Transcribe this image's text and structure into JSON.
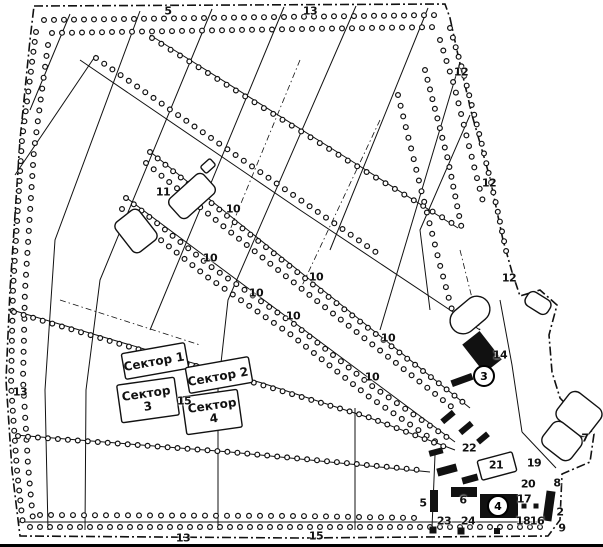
{
  "figure": {
    "type": "scanned-map-plan",
    "language": "Russian",
    "background": "#ffffff",
    "ink_color": "#111111",
    "description": "Hand-drawn scanned plan of a tree-lined territory (fan-shaped street grid converging to an entrance at lower right) divided into numbered sectors with numbered objects"
  },
  "sectors": [
    {
      "lines": [
        "Сектор 1"
      ],
      "x": 154,
      "y": 362,
      "rot": -10
    },
    {
      "lines": [
        "Сектор 2"
      ],
      "x": 218,
      "y": 377,
      "rot": -10
    },
    {
      "lines": [
        "Сектор",
        "3"
      ],
      "x": 147,
      "y": 400,
      "rot": -8
    },
    {
      "lines": [
        "Сектор",
        "4"
      ],
      "x": 213,
      "y": 412,
      "rot": -8
    }
  ],
  "labels": [
    {
      "text": "5",
      "x": 168,
      "y": 11
    },
    {
      "text": "13",
      "x": 310,
      "y": 11
    },
    {
      "text": "12",
      "x": 461,
      "y": 72
    },
    {
      "text": "12",
      "x": 489,
      "y": 183
    },
    {
      "text": "12",
      "x": 509,
      "y": 278
    },
    {
      "text": "11",
      "x": 163,
      "y": 192
    },
    {
      "text": "10",
      "x": 233,
      "y": 209
    },
    {
      "text": "10",
      "x": 210,
      "y": 258
    },
    {
      "text": "10",
      "x": 256,
      "y": 293
    },
    {
      "text": "10",
      "x": 316,
      "y": 277
    },
    {
      "text": "10",
      "x": 293,
      "y": 316
    },
    {
      "text": "10",
      "x": 388,
      "y": 338
    },
    {
      "text": "10",
      "x": 372,
      "y": 377
    },
    {
      "text": "14",
      "x": 500,
      "y": 355
    },
    {
      "text": "13",
      "x": 20,
      "y": 392
    },
    {
      "text": "15",
      "x": 184,
      "y": 401
    },
    {
      "text": "22",
      "x": 469,
      "y": 448
    },
    {
      "text": "21",
      "x": 496,
      "y": 465
    },
    {
      "text": "19",
      "x": 534,
      "y": 463
    },
    {
      "text": "7",
      "x": 585,
      "y": 438
    },
    {
      "text": "20",
      "x": 528,
      "y": 484
    },
    {
      "text": "8",
      "x": 557,
      "y": 483
    },
    {
      "text": "17",
      "x": 524,
      "y": 499
    },
    {
      "text": "6",
      "x": 463,
      "y": 500
    },
    {
      "text": "5",
      "x": 423,
      "y": 503
    },
    {
      "text": "2",
      "x": 560,
      "y": 512
    },
    {
      "text": "9",
      "x": 562,
      "y": 528
    },
    {
      "text": "18",
      "x": 523,
      "y": 521
    },
    {
      "text": "16",
      "x": 537,
      "y": 521
    },
    {
      "text": "23",
      "x": 444,
      "y": 521
    },
    {
      "text": "24",
      "x": 468,
      "y": 521
    },
    {
      "text": "15",
      "x": 316,
      "y": 536
    },
    {
      "text": "13",
      "x": 183,
      "y": 538
    }
  ],
  "circled_labels": [
    {
      "text": "3",
      "x": 484,
      "y": 376
    },
    {
      "text": "4",
      "x": 498,
      "y": 506
    }
  ]
}
